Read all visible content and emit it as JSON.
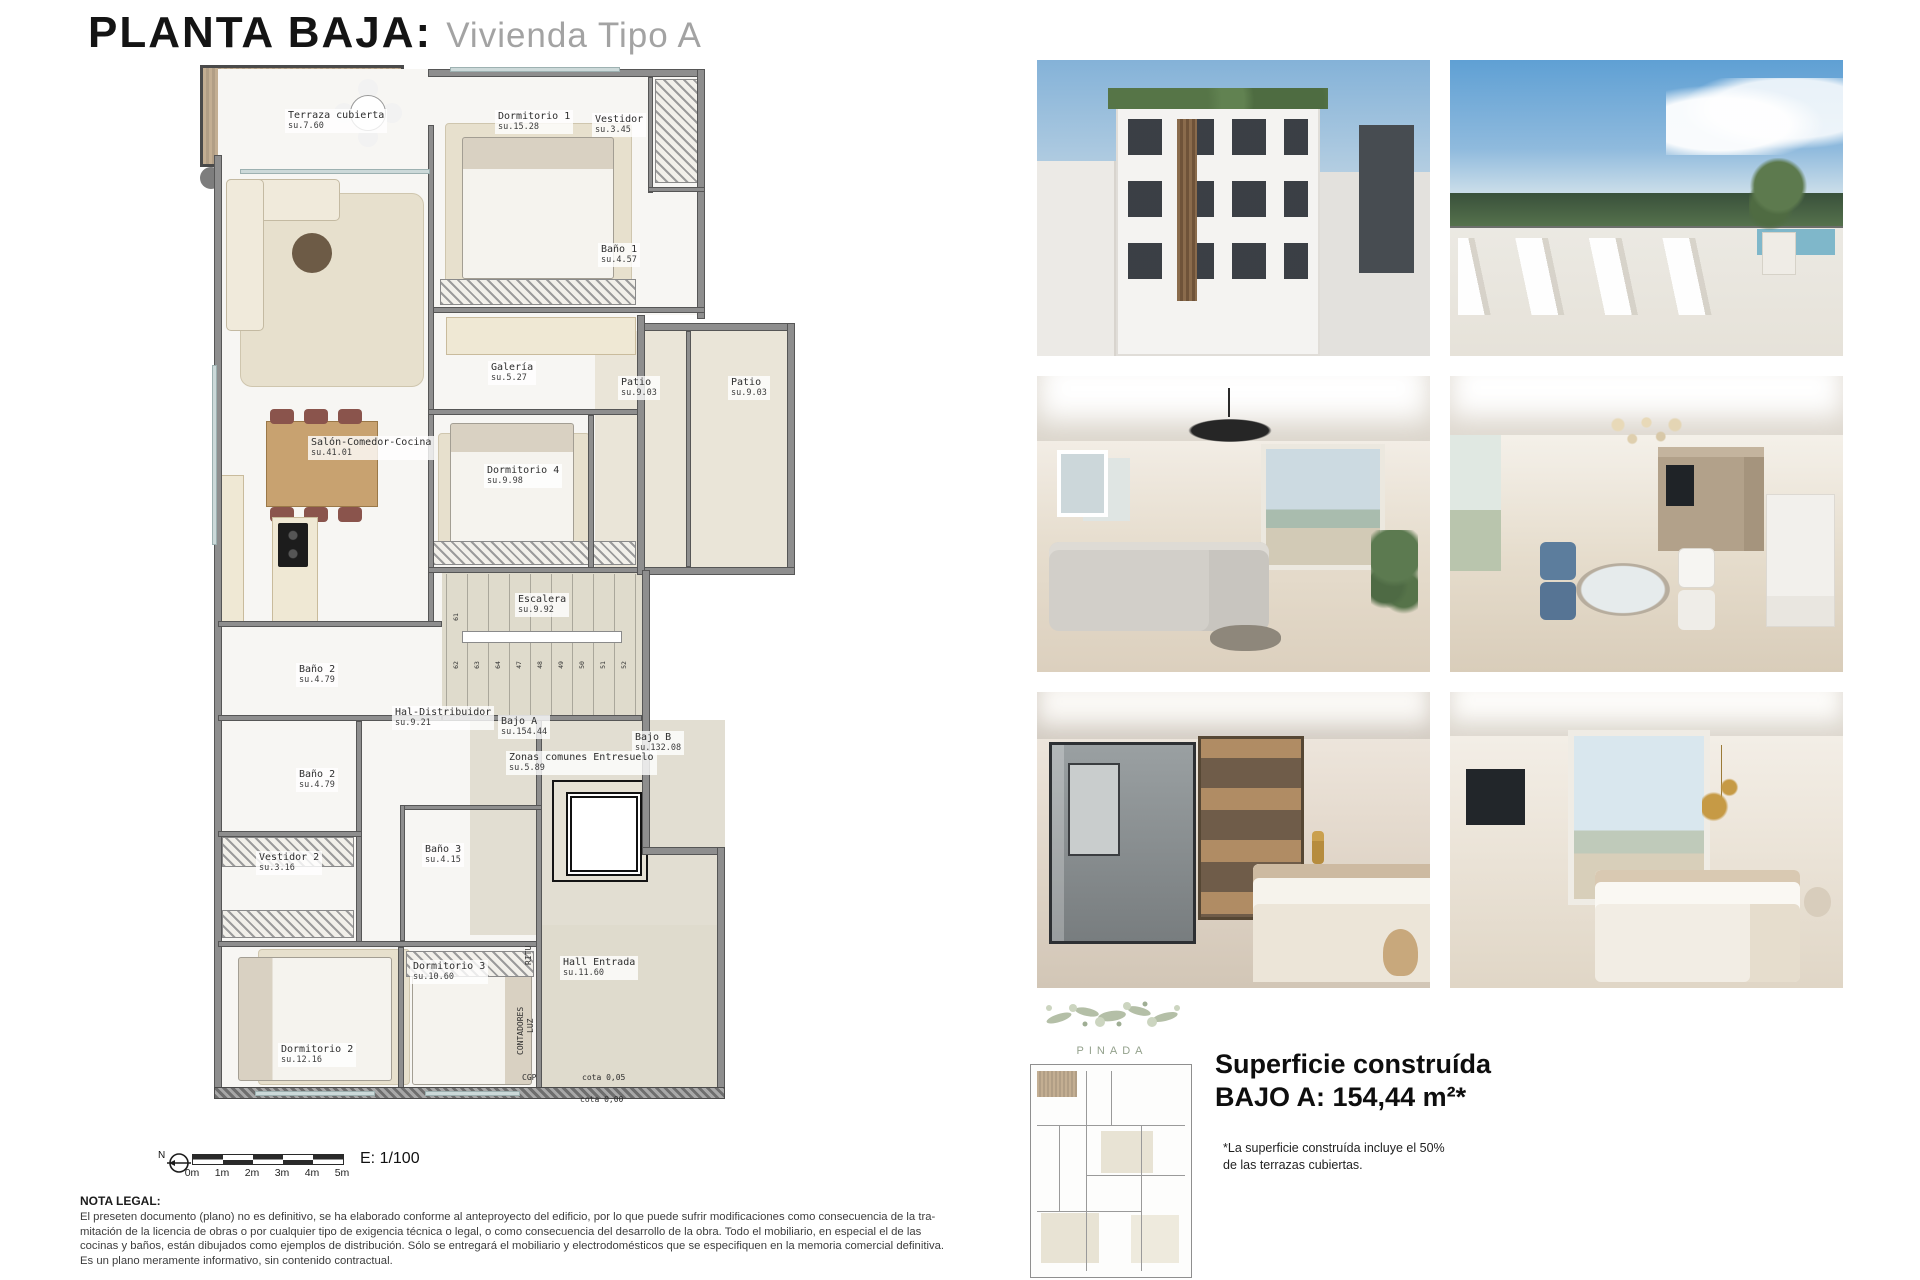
{
  "title": {
    "main": "PLANTA BAJA:",
    "sub": "Vivienda Tipo A"
  },
  "plan": {
    "rooms": [
      {
        "name": "Terraza cubierta",
        "area": "su.7.60",
        "x": 85,
        "y": 44
      },
      {
        "name": "Dormitorio 1",
        "area": "su.15.28",
        "x": 295,
        "y": 45
      },
      {
        "name": "Vestidor",
        "area": "su.3.45",
        "x": 392,
        "y": 48
      },
      {
        "name": "Baño 1",
        "area": "su.4.57",
        "x": 398,
        "y": 178
      },
      {
        "name": "Galería",
        "area": "su.5.27",
        "x": 288,
        "y": 296
      },
      {
        "name": "Patio",
        "area": "su.9.03",
        "x": 418,
        "y": 311
      },
      {
        "name": "Patio",
        "area": "su.9.03",
        "x": 528,
        "y": 311
      },
      {
        "name": "Salón-Comedor-Cocina",
        "area": "su.41.01",
        "x": 108,
        "y": 371
      },
      {
        "name": "Dormitorio 4",
        "area": "su.9.98",
        "x": 284,
        "y": 399
      },
      {
        "name": "Escalera",
        "area": "su.9.92",
        "x": 315,
        "y": 528
      },
      {
        "name": "Baño 2",
        "area": "su.4.79",
        "x": 96,
        "y": 598
      },
      {
        "name": "Hal-Distribuidor",
        "area": "su.9.21",
        "x": 192,
        "y": 641
      },
      {
        "name": "Bajo A",
        "area": "su.154.44",
        "x": 298,
        "y": 650
      },
      {
        "name": "Bajo B",
        "area": "su.132.08",
        "x": 432,
        "y": 666
      },
      {
        "name": "Zonas comunes Entresuelo",
        "area": "su.5.89",
        "x": 306,
        "y": 686
      },
      {
        "name": "Baño 2",
        "area": "su.4.79",
        "x": 96,
        "y": 703
      },
      {
        "name": "Vestidor 2",
        "area": "su.3.16",
        "x": 56,
        "y": 786
      },
      {
        "name": "Baño 3",
        "area": "su.4.15",
        "x": 222,
        "y": 778
      },
      {
        "name": "Dormitorio 3",
        "area": "su.10.60",
        "x": 210,
        "y": 895
      },
      {
        "name": "Hall Entrada",
        "area": "su.11.60",
        "x": 360,
        "y": 891
      },
      {
        "name": "Dormitorio 2",
        "area": "su.12.16",
        "x": 78,
        "y": 978
      }
    ],
    "annotations": [
      {
        "text": "RITU",
        "x": 324,
        "y": 900,
        "rot": true
      },
      {
        "text": "CONTADORES",
        "x": 316,
        "y": 990,
        "rot": true
      },
      {
        "text": "LUZ",
        "x": 326,
        "y": 968,
        "rot": true
      },
      {
        "text": "CGP",
        "x": 322,
        "y": 1008,
        "rot": false
      },
      {
        "text": "cota 0,05",
        "x": 382,
        "y": 1008,
        "rot": false
      },
      {
        "text": "cota 0,00",
        "x": 380,
        "y": 1030,
        "rot": false
      }
    ],
    "stair_top_number": "61",
    "stair_numbers": [
      "62",
      "63",
      "64",
      "47",
      "48",
      "49",
      "50",
      "51",
      "52"
    ],
    "scale": {
      "north": "N",
      "ticks": [
        "0m",
        "1m",
        "2m",
        "3m",
        "4m",
        "5m"
      ],
      "ratio": "E: 1/100"
    }
  },
  "legal": {
    "heading": "NOTA LEGAL:",
    "lines": [
      "El preseten documento (plano) no es definitivo, se ha elaborado conforme al anteproyecto del edificio, por lo que puede sufrir modificaciones como consecuencia de la tra-",
      "mitación de la licencia de obras o por cualquier tipo de exigencia técnica o legal, o como consecuencia del desarrollo de la obra. Todo el mobiliario, en especial el de las",
      "cocinas y baños, están dibujados como ejemplos de distribución. Sólo se entregará el mobiliario y electrodomésticos que se especifiquen en la memoria comercial definitiva.",
      "Es un plano meramente informativo, sin contenido contractual."
    ]
  },
  "summary": {
    "line1": "Superficie construída",
    "line2": "BAJO A: 154,44 m²*",
    "footnote": "*La superficie construída incluye el 50% de las  terrazas cubiertas."
  },
  "brand": {
    "name": "PINADA"
  },
  "photos": [
    {
      "id": "p1",
      "name": "building-exterior-photo"
    },
    {
      "id": "p2",
      "name": "rooftop-terrace-photo"
    },
    {
      "id": "p3",
      "name": "living-room-photo"
    },
    {
      "id": "p4",
      "name": "dining-room-photo"
    },
    {
      "id": "p5",
      "name": "bedroom-suite-photo"
    },
    {
      "id": "p6",
      "name": "bedroom-photo"
    }
  ]
}
